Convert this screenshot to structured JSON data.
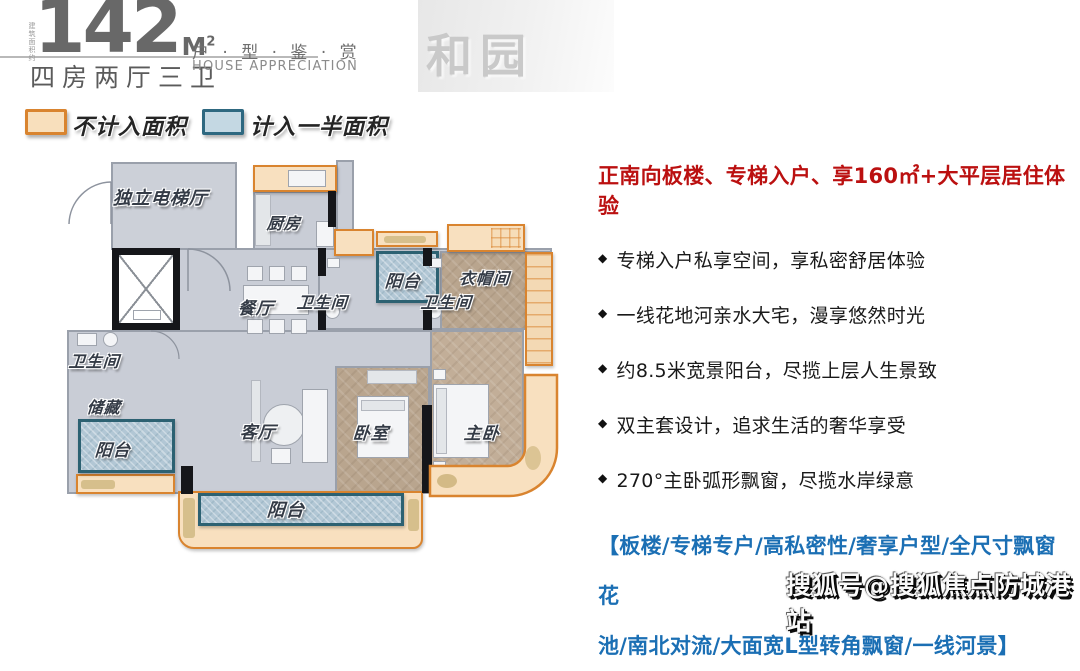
{
  "header": {
    "area_note": "建筑面积约",
    "area_value": "142",
    "area_unit_main": "M",
    "area_unit_sup": "2",
    "layout": "四房两厅三卫",
    "series_title": "户 · 型 · 鉴 · 赏",
    "series_subtitle": "HOUSE APPRECIATION"
  },
  "legend": {
    "not_counted": "不计入面积",
    "half_counted": "计入一半面积"
  },
  "floorplan": {
    "rooms": [
      {
        "label": "独立电梯厅"
      },
      {
        "label": "厨房"
      },
      {
        "label": "餐厅"
      },
      {
        "label": "卫生间"
      },
      {
        "label": "储藏"
      },
      {
        "label": "阳台"
      },
      {
        "label": "卫生间"
      },
      {
        "label": "阳台"
      },
      {
        "label": "卫生间"
      },
      {
        "label": "衣帽间"
      },
      {
        "label": "客厅"
      },
      {
        "label": "卧室"
      },
      {
        "label": "主卧"
      },
      {
        "label": "阳台"
      }
    ]
  },
  "details": {
    "headline": "正南向板楼、专梯入户、享160㎡+大平层居住体验",
    "bullet_icon": "◆",
    "bullets": [
      "专梯入户私享空间，享私密舒居体验",
      "一线花地河亲水大宅，漫享悠然时光",
      "约8.5米宽景阳台，尽揽上层人生景致",
      "双主套设计，追求生活的奢华享受",
      "270°主卧弧形飘窗，尽揽水岸绿意"
    ],
    "tags_line1": "【板楼/专梯专户/高私密性/奢享户型/全尺寸飘窗花",
    "tags_line2": "池/南北对流/大面宽L型转角飘窗/一线河景】"
  },
  "watermarks": {
    "brand": "和园",
    "sohu": "搜狐号@搜狐焦点防城港站"
  },
  "colors": {
    "highlight_orange_border": "#d9842f",
    "highlight_orange_fill": "#f8e0bf",
    "highlight_blue_border": "#2c6172",
    "highlight_blue_fill": "#b2c7d5",
    "headline_red": "#bb1010",
    "tag_blue": "#1b6fb4",
    "title_gray": "#686868"
  }
}
